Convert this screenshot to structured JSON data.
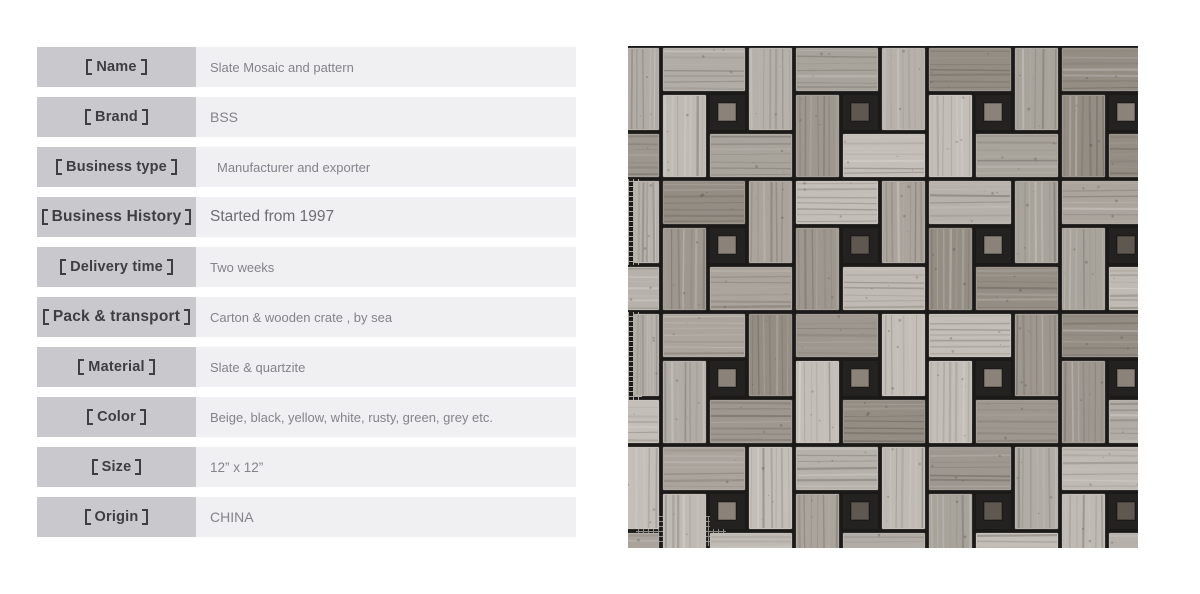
{
  "spec_table": {
    "rows": [
      {
        "label": "【Name】",
        "value": "Slate Mosaic and pattern"
      },
      {
        "label": "【Brand】",
        "value": "BSS"
      },
      {
        "label": "【Business type】",
        "value": "Manufacturer and exporter"
      },
      {
        "label": "【Business History】",
        "value": "Started from 1997"
      },
      {
        "label": "【Delivery time】",
        "value": "Two weeks"
      },
      {
        "label": "【Pack & transport】",
        "value": "Carton & wooden crate ,  by sea"
      },
      {
        "label": "【Material】",
        "value": "Slate & quartzite"
      },
      {
        "label": "【Color】",
        "value": "Beige, black, yellow, white, rusty, green, grey etc."
      },
      {
        "label": "【Size】",
        "value": "12” x 12”"
      },
      {
        "label": "【Origin】",
        "value": "CHINA"
      }
    ],
    "colors": {
      "label_bg": "#c9c8cd",
      "value_bg": "#f0eff2",
      "label_text": "#3e3d43",
      "value_text": "#84838a",
      "value_text_emphasis": "#6e6d73"
    }
  },
  "product_image": {
    "type": "basketweave-mosaic-tile-photo",
    "colors": {
      "grout": "#1b1a18",
      "pocket": "#242220",
      "tile_palette": [
        "#b6b1aa",
        "#a8a39b",
        "#bfbab3",
        "#9d978f",
        "#b1aca5",
        "#c3beb7",
        "#aaa49c",
        "#938d84"
      ],
      "grain_dark": "#4a443d",
      "grain_light": "#ffffff",
      "dot": "#8b8279",
      "dot_dark": "#5f5851",
      "mesh": "#d8d6d2"
    }
  }
}
